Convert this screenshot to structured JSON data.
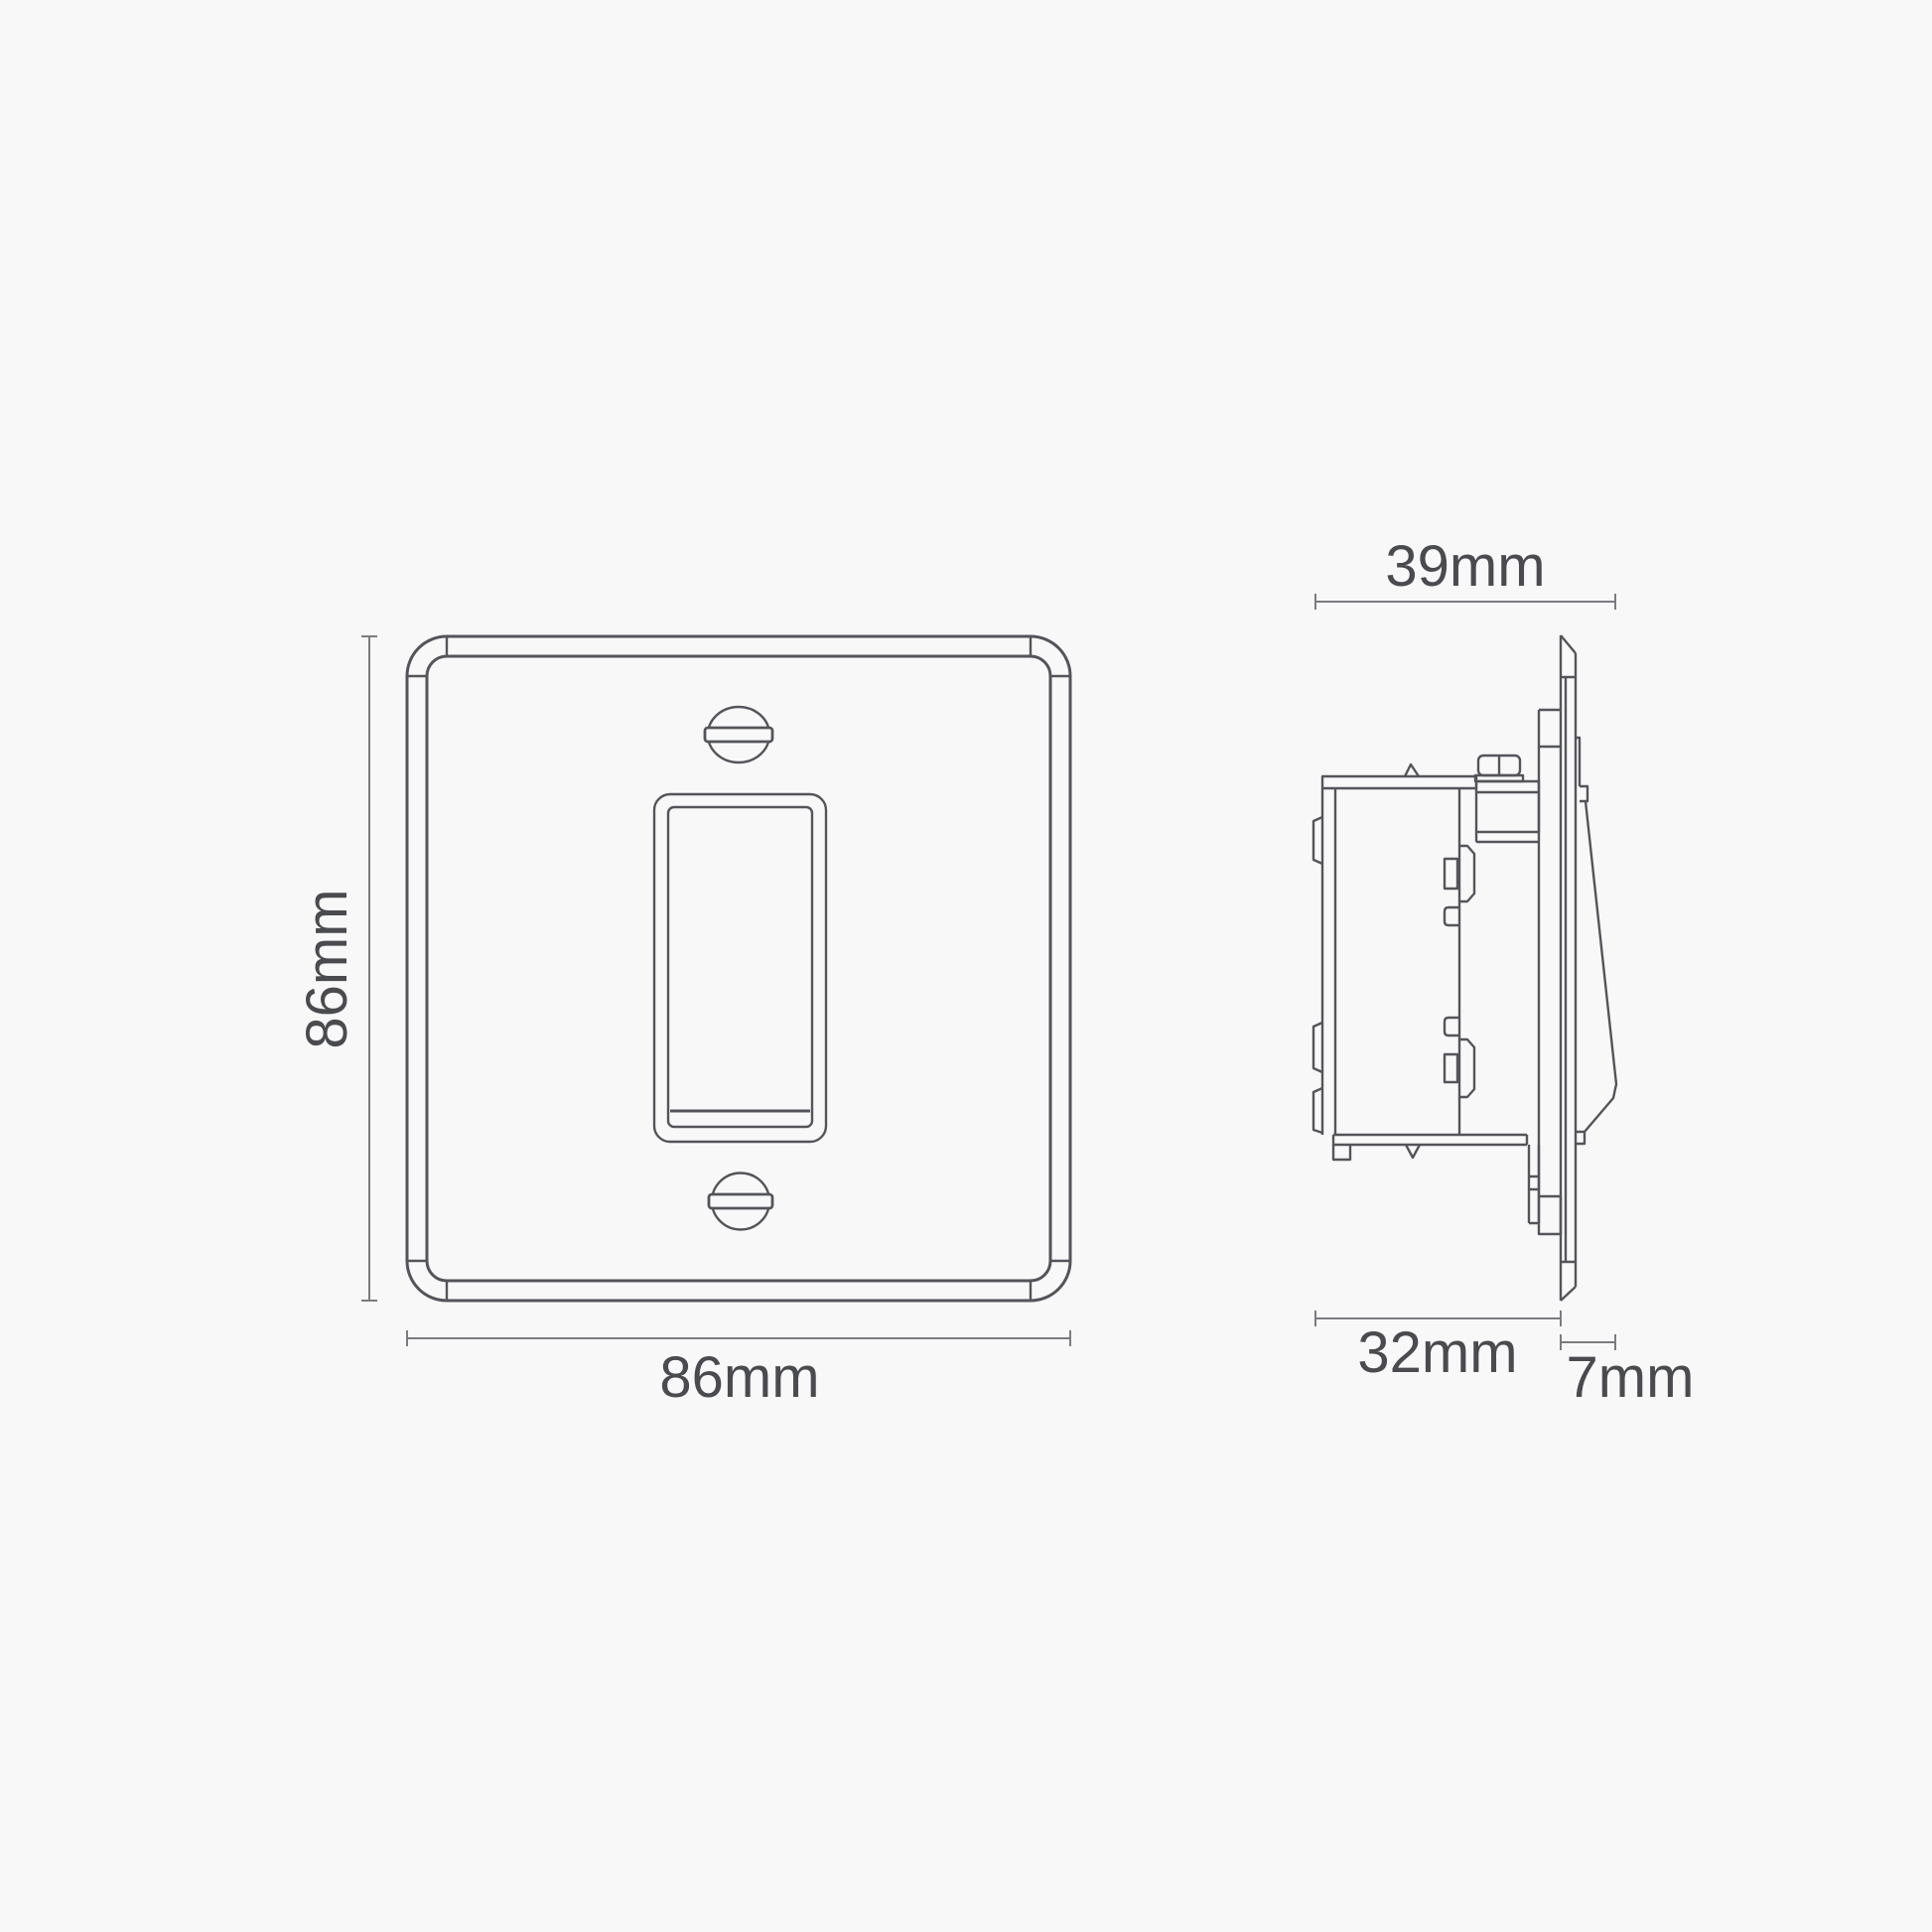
{
  "diagram": {
    "description": "Technical dimension drawing of a single rocker light switch, front view and side view",
    "front_view": {
      "name": "front-view",
      "height_label": "86mm",
      "width_label": "86mm"
    },
    "side_view": {
      "name": "side-view",
      "total_depth_label": "39mm",
      "box_depth_label": "32mm",
      "faceplate_projection_label": "7mm"
    },
    "colors": {
      "background": "#f8f8f8",
      "line": "#54555a",
      "dimension_line": "#7b7c80",
      "label_text": "#4a4b4f"
    }
  }
}
